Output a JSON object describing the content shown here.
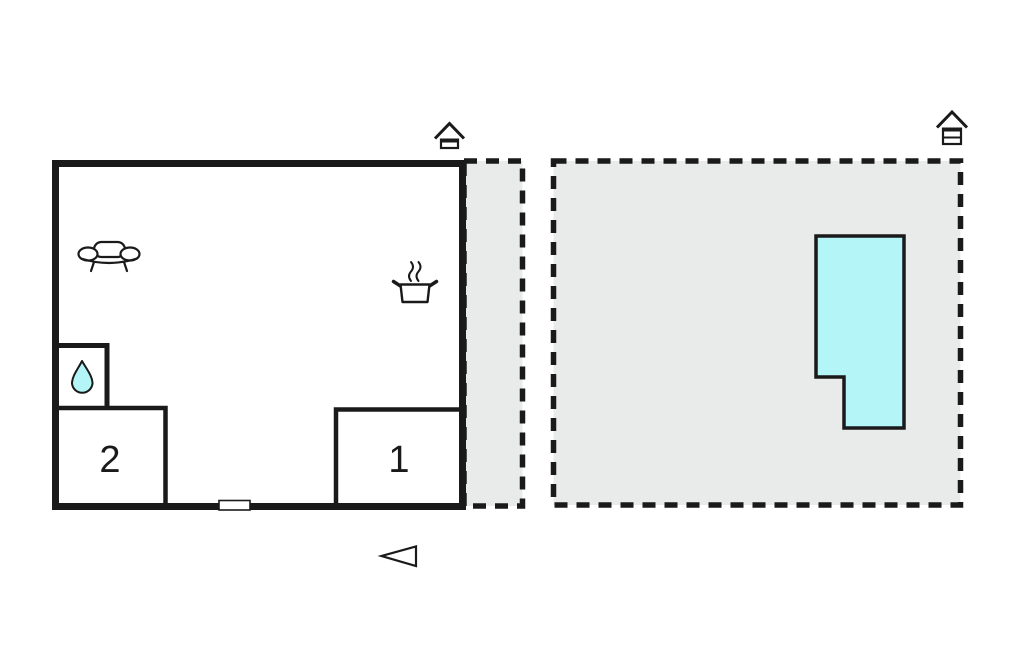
{
  "floorplan": {
    "rooms": [
      {
        "id": "room-1",
        "label": "1"
      },
      {
        "id": "room-2",
        "label": "2"
      }
    ],
    "colors": {
      "outline": "#1a1a1a",
      "ground": "#e9ebeb",
      "pool": "#b4f5f8",
      "water_drop": "#b4f5f8",
      "interior": "#ffffff"
    },
    "icons": {
      "sofa": "sofa-icon",
      "cooking_pot": "cooking-pot-icon",
      "water_drop": "water-drop-icon",
      "house_marker_building": "house-marker-icon",
      "house_marker_plot": "house-marker-icon",
      "entrance_arrow": "entrance-arrow-icon",
      "door": "door-marker"
    }
  }
}
